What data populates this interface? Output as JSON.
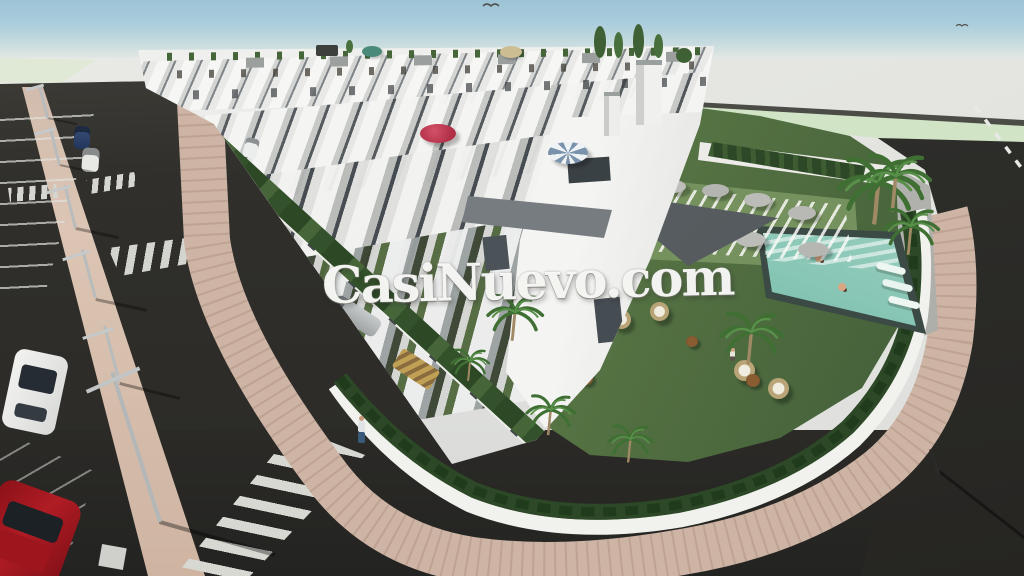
{
  "watermark": {
    "text": "CasiNuevo.com"
  },
  "scene": {
    "type": "3d-architectural-render-aerial",
    "subject": "New-build white terraced townhouse development with roof terraces, private driveways, communal garden with swimming pool, sun loungers, parasols and palm trees, surrounded by asphalt streets with parked cars, lamp posts and zebra crossings",
    "colors": {
      "sky": "#a9cbd9",
      "horizon": "#e7e8e4",
      "asphalt": "#2e2d2a",
      "sidewalk_paving": "#cdb4a4",
      "lawn": "#5e7c48",
      "hedge": "#2c4826",
      "pool_water": "#7cc0ae",
      "building_white": "#f0f1ef",
      "umbrella_red": "#c0384e",
      "umbrella_gray": "#b8b9b4",
      "car_red": "#a01820",
      "car_blue": "#22365c"
    }
  }
}
